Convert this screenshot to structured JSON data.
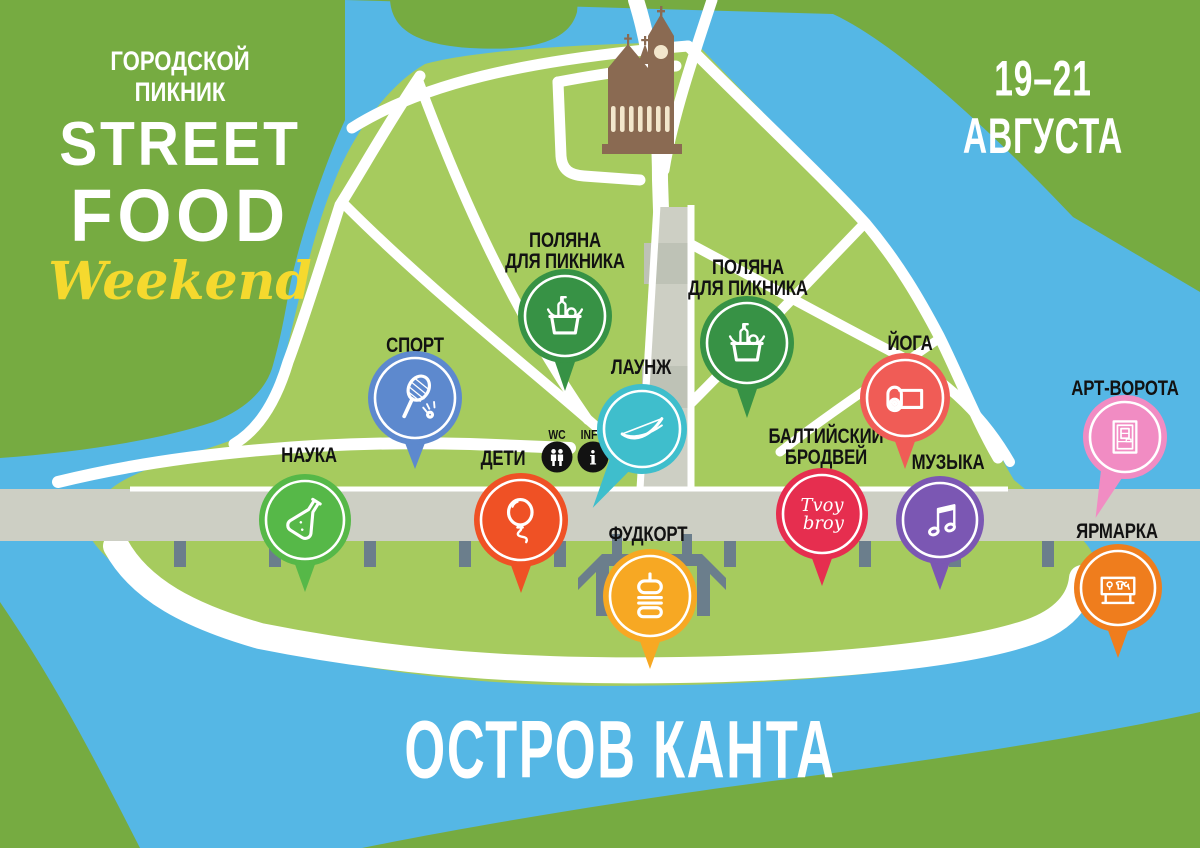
{
  "branding": {
    "event_type": "ГОРОДСКОЙ ПИКНИК",
    "title_line1": "STREET",
    "title_line2": "FOOD",
    "title_script": "Weekend",
    "dates": "19–21 АВГУСТА"
  },
  "island_name": "ОСТРОВ КАНТА",
  "palette": {
    "background_green": "#76ab41",
    "island_green": "#a6cb5e",
    "water_blue": "#55b7e5",
    "road_gray": "#cdcfc4",
    "road_gray_dark": "#bec2b6",
    "pillar_gray": "#6b7e8c",
    "cathedral_brown": "#8a6a52",
    "cathedral_cream": "#f2e6cc",
    "label_black": "#121212",
    "title_white": "#ffffff",
    "script_yellow": "#f5d92e"
  },
  "pins": [
    {
      "id": "science",
      "label": "НАУКА",
      "icon": "flask",
      "color": "#56b848",
      "x": 305,
      "y": 520,
      "r": 46,
      "tail_angle": 0,
      "tail_len": 26,
      "label_x": 309,
      "label_y": 445
    },
    {
      "id": "sport",
      "label": "СПОРТ",
      "icon": "badminton",
      "color": "#5d89ce",
      "x": 415,
      "y": 398,
      "r": 47,
      "tail_angle": 0,
      "tail_len": 24,
      "label_x": 415,
      "label_y": 335
    },
    {
      "id": "kids",
      "label": "ДЕТИ",
      "icon": "balloon",
      "color": "#ef5125",
      "x": 521,
      "y": 520,
      "r": 47,
      "tail_angle": 0,
      "tail_len": 26,
      "label_x": 503,
      "label_y": 448
    },
    {
      "id": "picnic-meadow-1",
      "label": "ПОЛЯНА\nДЛЯ ПИКНИКА",
      "icon": "basket",
      "color": "#379245",
      "x": 565,
      "y": 316,
      "r": 47,
      "tail_angle": 0,
      "tail_len": 28,
      "label_x": 565,
      "label_y": 230
    },
    {
      "id": "picnic-meadow-2",
      "label": "ПОЛЯНА\nДЛЯ ПИКНИКА",
      "icon": "basket",
      "color": "#379245",
      "x": 747,
      "y": 343,
      "r": 47,
      "tail_angle": 0,
      "tail_len": 28,
      "label_x": 748,
      "label_y": 257
    },
    {
      "id": "lounge",
      "label": "ЛАУНЖ",
      "icon": "hammock",
      "color": "#3fbecc",
      "x": 642,
      "y": 429,
      "r": 45,
      "tail_angle": 32,
      "tail_len": 48,
      "label_x": 641,
      "label_y": 357
    },
    {
      "id": "food-court",
      "label": "ФУДКОРТ",
      "icon": "burger",
      "color": "#f7a823",
      "x": 650,
      "y": 596,
      "r": 47,
      "tail_angle": 0,
      "tail_len": 26,
      "label_x": 648,
      "label_y": 524
    },
    {
      "id": "baltic-broadway",
      "label": "БАЛТИЙСКИЙ\nБРОДВЕЙ",
      "icon": "tvoy-broy",
      "color": "#e62e4f",
      "x": 822,
      "y": 514,
      "r": 46,
      "tail_angle": 0,
      "tail_len": 26,
      "label_x": 826,
      "label_y": 426
    },
    {
      "id": "yoga",
      "label": "ЙОГА",
      "icon": "yoga-mat",
      "color": "#f05c56",
      "x": 905,
      "y": 398,
      "r": 45,
      "tail_angle": 0,
      "tail_len": 26,
      "label_x": 910,
      "label_y": 333
    },
    {
      "id": "music",
      "label": "МУЗЫКА",
      "icon": "music-note",
      "color": "#7b57b3",
      "x": 940,
      "y": 520,
      "r": 44,
      "tail_angle": 0,
      "tail_len": 26,
      "label_x": 948,
      "label_y": 452
    },
    {
      "id": "art-gates",
      "label": "АРТ-ВОРОТА",
      "icon": "gate",
      "color": "#f18cc3",
      "x": 1125,
      "y": 437,
      "r": 42,
      "tail_angle": 20,
      "tail_len": 44,
      "label_x": 1125,
      "label_y": 378
    },
    {
      "id": "fair",
      "label": "ЯРМАРКА",
      "icon": "market-stall",
      "color": "#ef7d1d",
      "x": 1118,
      "y": 588,
      "r": 44,
      "tail_angle": 0,
      "tail_len": 26,
      "label_x": 1117,
      "label_y": 521
    }
  ],
  "services": [
    {
      "id": "wc",
      "label": "WC",
      "icon": "wc",
      "x": 557,
      "y": 457
    },
    {
      "id": "info",
      "label": "INFO",
      "icon": "info",
      "x": 593,
      "y": 457
    }
  ]
}
